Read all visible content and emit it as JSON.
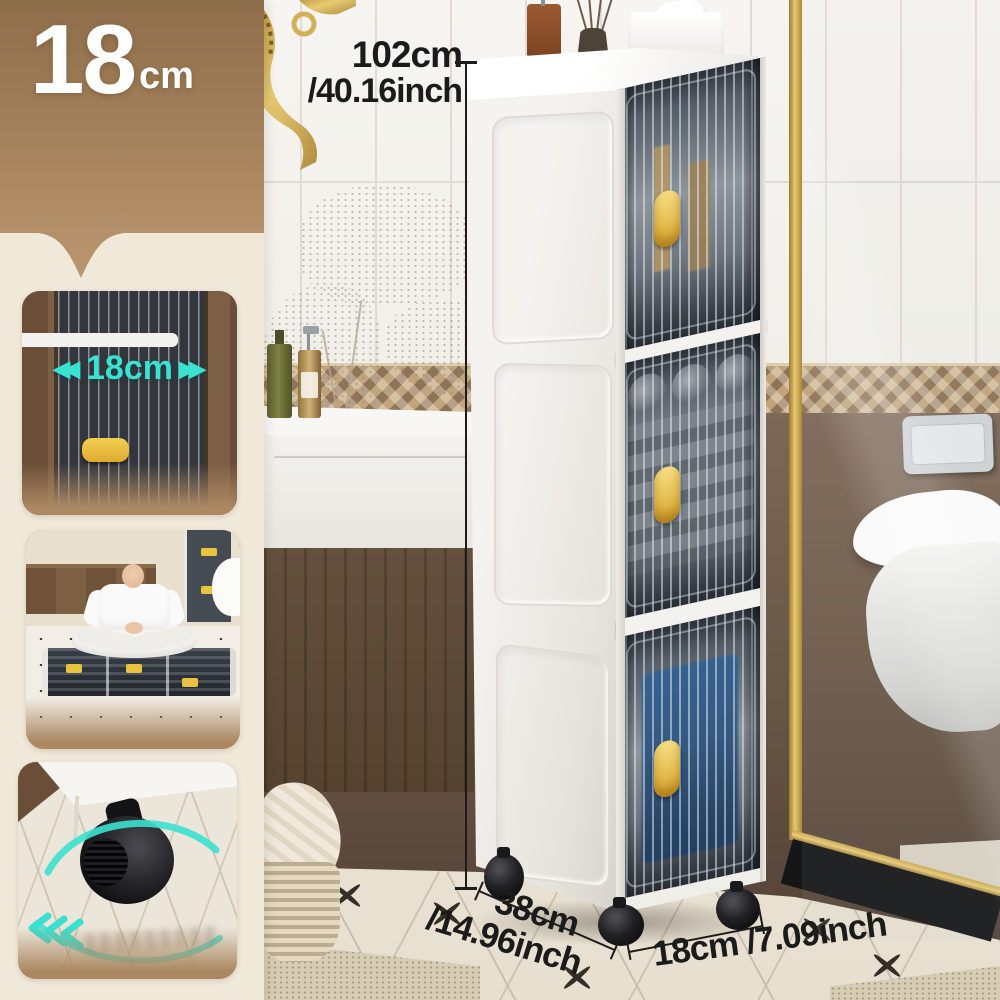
{
  "badge": {
    "value": "18",
    "unit": "cm"
  },
  "annotations": {
    "height_cm": "102cm",
    "height_inch": "/40.16inch",
    "depth_cm": "38cm",
    "depth_inch": "/14.96inch",
    "width_cm": "18cm",
    "width_inch": "/7.09inch"
  },
  "sidebar": {
    "panels": [
      {
        "id": "width-demo",
        "label": "18cm",
        "left_arrows": "◀◀",
        "right_arrows": "▶▶"
      },
      {
        "id": "foldable-demo"
      },
      {
        "id": "caster-wheel-demo"
      }
    ]
  },
  "colors": {
    "accent_cyan": "#3ae2d2",
    "handle_gold": "#e0ab2e",
    "annotation_black": "#1b1b1b",
    "header_brown_top": "#8e6d4a",
    "header_brown_bottom": "#bb9770",
    "sidebar_cream": "#f0e9d9"
  }
}
